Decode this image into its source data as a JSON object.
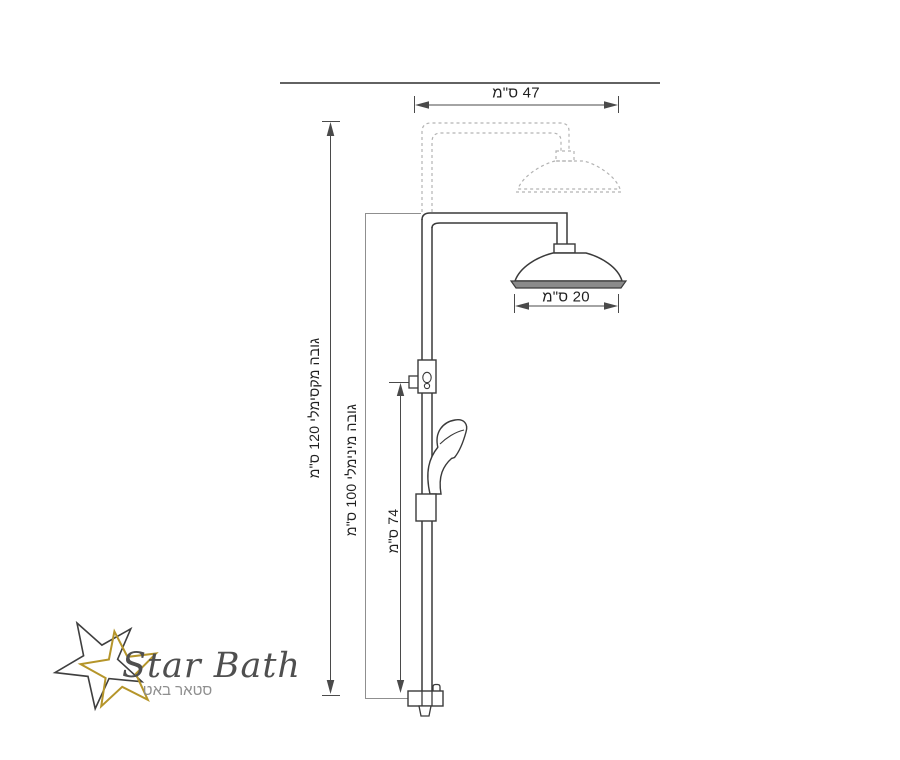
{
  "diagram": {
    "description": "Shower column dimension drawing",
    "labels": {
      "arm_width": "47 ס\"מ",
      "head_diameter": "20 ס\"מ",
      "max_height": "גובה מקסימלי 120 ס\"מ",
      "min_height": "גובה מינימלי 100 ס\"מ",
      "slider_height": "74 ס\"מ"
    },
    "values": {
      "arm_width_cm": 47,
      "head_diameter_cm": 20,
      "max_height_cm": 120,
      "min_height_cm": 100,
      "slider_height_cm": 74
    }
  },
  "logo": {
    "brand": "Star Bath",
    "brand_he": "סטאר באט"
  },
  "colors": {
    "line": "#3a3a3a",
    "dimension": "#4a4a4a",
    "light_dimension": "#8f8f8f",
    "phantom_dash": "#b3b3b3",
    "rim_fill": "#8a8a8a",
    "gold": "#b5952a",
    "logo_text": "#4f4f4f",
    "logo_sub": "#8f8f8f"
  }
}
